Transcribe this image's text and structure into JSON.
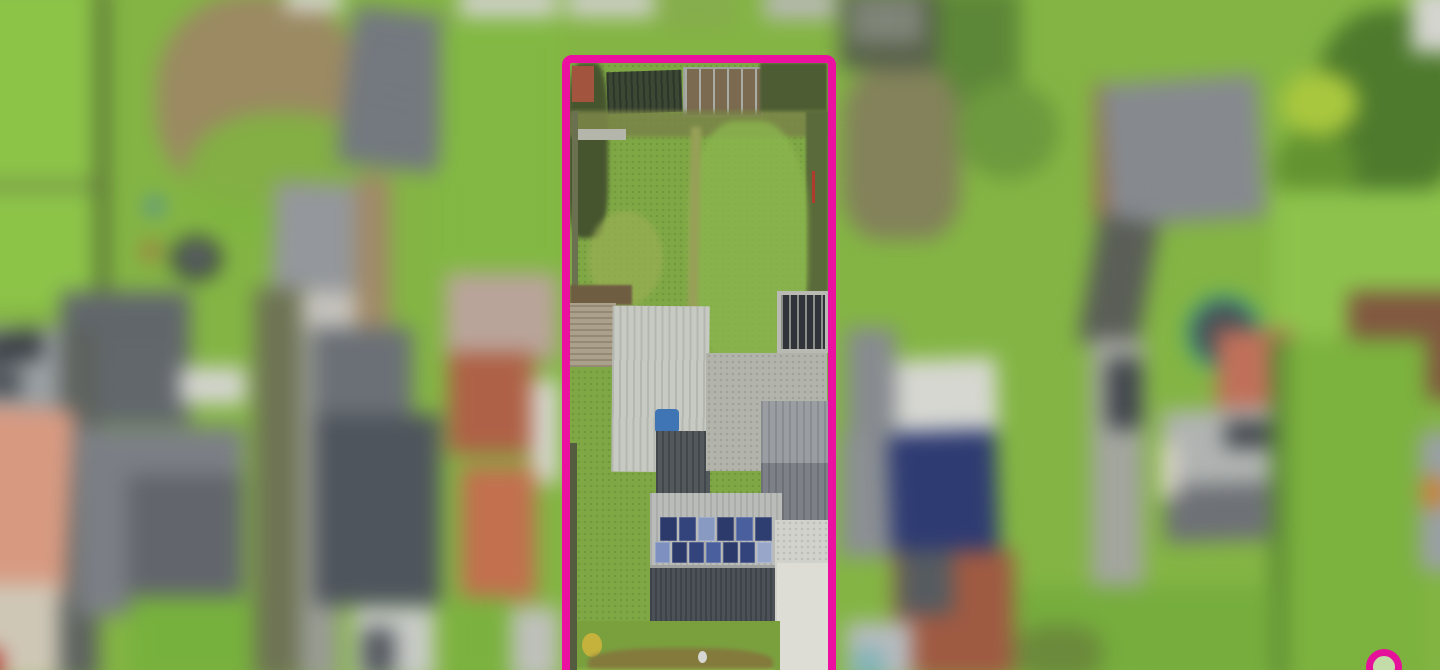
{
  "image": {
    "kind": "aerial-drone-photograph",
    "subject": "residential plot outlined with magenta boundary, surroundings blurred"
  },
  "colors": {
    "boundary": "#EC10A0",
    "watermark": "#E5119B",
    "base_grass": "#84B544",
    "plot_grass": "#7FA845"
  },
  "background": [
    {
      "n": "lawn-top-left",
      "x": 0,
      "y": 0,
      "w": 125,
      "h": 310,
      "c": "#8cc448"
    },
    {
      "n": "fence-line-top-left",
      "x": 118,
      "y": 0,
      "w": 9,
      "h": 295,
      "c": "#44502f"
    },
    {
      "n": "dead-shrub-patch",
      "x": 175,
      "y": 5,
      "w": 200,
      "h": 205,
      "c": "#9b8a62",
      "rad": "45%"
    },
    {
      "n": "grass-over-shrub",
      "x": 205,
      "y": 120,
      "w": 185,
      "h": 125,
      "c": "#7fb53f",
      "rad": "45%",
      "op": 0.85
    },
    {
      "n": "white-roof-top-1",
      "x": 300,
      "y": 0,
      "w": 55,
      "h": 22,
      "c": "#d6d7d0"
    },
    {
      "n": "grey-roof-top-left",
      "x": 358,
      "y": 22,
      "w": 98,
      "h": 152,
      "c": "#70757b",
      "rot": 7,
      "st": {
        "d": 7,
        "c": "#7e838a",
        "t": 3,
        "s": 12
      }
    },
    {
      "n": "white-roof-top-2",
      "x": 468,
      "y": 0,
      "w": 95,
      "h": 28,
      "c": "#cfd0c9"
    },
    {
      "n": "green-strip-left",
      "x": 450,
      "y": 30,
      "w": 115,
      "h": 270,
      "c": "#82b843"
    },
    {
      "n": "fence-horizontal-left",
      "x": 0,
      "y": 188,
      "w": 118,
      "h": 6,
      "c": "#687748"
    },
    {
      "n": "grey-roof-mid-left",
      "x": 288,
      "y": 188,
      "w": 90,
      "h": 105,
      "c": "#94979b",
      "rot": 2
    },
    {
      "n": "white-wall-mid-left",
      "x": 300,
      "y": 293,
      "w": 75,
      "h": 45,
      "c": "#c6c3bd"
    },
    {
      "n": "tan-lane-vertical",
      "x": 368,
      "y": 180,
      "w": 34,
      "h": 160,
      "c": "#a08a68"
    },
    {
      "n": "blue-barrel",
      "x": 166,
      "y": 203,
      "w": 15,
      "h": 15,
      "c": "#3f7fc1",
      "rad": "50%"
    },
    {
      "n": "red-barrel",
      "x": 163,
      "y": 247,
      "w": 14,
      "h": 14,
      "c": "#bf4a40",
      "rad": "50%"
    },
    {
      "n": "black-tub",
      "x": 190,
      "y": 240,
      "w": 48,
      "h": 42,
      "c": "#383d42",
      "rad": "50%"
    },
    {
      "n": "black-tub-inner",
      "x": 202,
      "y": 250,
      "w": 24,
      "h": 20,
      "c": "#6e7478",
      "rad": "50%"
    },
    {
      "n": "barn-roof-left",
      "x": 83,
      "y": 293,
      "w": 125,
      "h": 128,
      "c": "#676c71",
      "st": {
        "d": 0,
        "c": "#565b60",
        "t": 4,
        "s": 13
      }
    },
    {
      "n": "white-strip-mid-left",
      "x": 198,
      "y": 366,
      "w": 64,
      "h": 36,
      "c": "#d3d4ce"
    },
    {
      "n": "dark-path-vertical-left",
      "x": 80,
      "y": 330,
      "w": 40,
      "h": 340,
      "c": "#5e635f"
    },
    {
      "n": "driveway-cars-top-left",
      "x": 0,
      "y": 328,
      "w": 82,
      "h": 84,
      "c": "#9aa0a3"
    },
    {
      "n": "parked-car-1",
      "x": 8,
      "y": 332,
      "w": 58,
      "h": 30,
      "c": "#3c4147",
      "rot": -8,
      "rad": 6
    },
    {
      "n": "parked-car-2",
      "x": 5,
      "y": 368,
      "w": 40,
      "h": 26,
      "c": "#4a5056",
      "rot": 5,
      "rad": 6
    },
    {
      "n": "salmon-tiled-roof",
      "x": -8,
      "y": 405,
      "w": 100,
      "h": 180,
      "c": "#d79a81",
      "rot": 3
    },
    {
      "n": "dusty-pink-patio",
      "x": 455,
      "y": 275,
      "w": 108,
      "h": 85,
      "c": "#b9a49a"
    },
    {
      "n": "grey-house-left-roof",
      "x": 98,
      "y": 424,
      "w": 162,
      "h": 182,
      "c": "#7b7f85"
    },
    {
      "n": "grey-house-left-slope",
      "x": 148,
      "y": 470,
      "w": 112,
      "h": 136,
      "c": "#62666c"
    },
    {
      "n": "lawn-bottom-left",
      "x": 150,
      "y": 588,
      "w": 125,
      "h": 82,
      "c": "#77b13d"
    },
    {
      "n": "tan-pavement-bottom-left",
      "x": 0,
      "y": 575,
      "w": 82,
      "h": 95,
      "c": "#cfc7b6"
    },
    {
      "n": "red-car",
      "x": 0,
      "y": 638,
      "w": 26,
      "h": 32,
      "c": "#b2332c",
      "rad": 6
    },
    {
      "n": "olive-lane-vertical",
      "x": 270,
      "y": 290,
      "w": 46,
      "h": 380,
      "c": "#6e7354"
    },
    {
      "n": "grey-road-vertical-left",
      "x": 314,
      "y": 328,
      "w": 38,
      "h": 342,
      "c": "#999c93"
    },
    {
      "n": "house-center-left-upper",
      "x": 328,
      "y": 328,
      "w": 95,
      "h": 88,
      "c": "#6b7076"
    },
    {
      "n": "house-center-left-roof",
      "x": 328,
      "y": 412,
      "w": 122,
      "h": 184,
      "c": "#4f555d"
    },
    {
      "n": "brick-building-1",
      "x": 458,
      "y": 352,
      "w": 82,
      "h": 98,
      "c": "#ae6146"
    },
    {
      "n": "white-gap-left-of-plot",
      "x": 538,
      "y": 378,
      "w": 26,
      "h": 100,
      "c": "#d7d8d2"
    },
    {
      "n": "brick-building-2",
      "x": 470,
      "y": 462,
      "w": 72,
      "h": 128,
      "c": "#c2704e"
    },
    {
      "n": "lawn-under-brick",
      "x": 456,
      "y": 588,
      "w": 62,
      "h": 82,
      "c": "#7bb23f"
    },
    {
      "n": "white-drive-bottom-center",
      "x": 366,
      "y": 598,
      "w": 78,
      "h": 72,
      "c": "#c8cbc7"
    },
    {
      "n": "dark-car-bottom-center",
      "x": 374,
      "y": 618,
      "w": 32,
      "h": 48,
      "c": "#555a60",
      "rad": 5
    },
    {
      "n": "grey-patch-below-plot-left",
      "x": 518,
      "y": 598,
      "w": 47,
      "h": 72,
      "c": "#bec0ba"
    },
    {
      "n": "white-roof-above-plot",
      "x": 572,
      "y": 0,
      "w": 85,
      "h": 28,
      "c": "#cdcec7"
    },
    {
      "n": "green-above-plot",
      "x": 660,
      "y": 0,
      "w": 75,
      "h": 40,
      "c": "#86ad4c"
    },
    {
      "n": "grey-roof-above-plot",
      "x": 762,
      "y": 0,
      "w": 70,
      "h": 30,
      "c": "#b6b8b1"
    },
    {
      "n": "greenhouses-top-right",
      "x": 836,
      "y": 0,
      "w": 100,
      "h": 78,
      "c": "#57614a"
    },
    {
      "n": "greenhouse-frames",
      "x": 845,
      "y": 8,
      "w": 70,
      "h": 45,
      "c": "#8d9188",
      "st": {
        "d": 90,
        "c": "#5c6650",
        "t": 3,
        "s": 10
      }
    },
    {
      "n": "shrub-column-right",
      "x": 930,
      "y": 0,
      "w": 80,
      "h": 135,
      "c": "#5d8738"
    },
    {
      "n": "brown-shrubs-right",
      "x": 838,
      "y": 78,
      "w": 115,
      "h": 165,
      "c": "#83825a",
      "rad": "30%"
    },
    {
      "n": "tree-blob-right",
      "x": 948,
      "y": 90,
      "w": 100,
      "h": 95,
      "c": "#6d9a3e",
      "rad": "50%"
    },
    {
      "n": "brick-edge-of-barn",
      "x": 1082,
      "y": 92,
      "w": 14,
      "h": 132,
      "c": "#996a50"
    },
    {
      "n": "barn-roof-right",
      "x": 1092,
      "y": 88,
      "w": 152,
      "h": 138,
      "c": "#898d92",
      "rot": -4,
      "st": {
        "d": 0,
        "c": "#797d82",
        "t": 3,
        "s": 14
      }
    },
    {
      "n": "conifer-trees-1",
      "x": 1295,
      "y": 20,
      "w": 145,
      "h": 185,
      "c": "#4e7a2d",
      "rad": "45%"
    },
    {
      "n": "conifer-trees-2",
      "x": 1255,
      "y": 135,
      "w": 80,
      "h": 80,
      "c": "#639331",
      "rad": "50%"
    },
    {
      "n": "lime-bush",
      "x": 1262,
      "y": 80,
      "w": 75,
      "h": 62,
      "c": "#a9c73e",
      "rad": "50%"
    },
    {
      "n": "white-corner-top-right",
      "x": 1388,
      "y": 0,
      "w": 52,
      "h": 62,
      "c": "#d4d5cf"
    },
    {
      "n": "lawn-top-right",
      "x": 1255,
      "y": 195,
      "w": 185,
      "h": 145,
      "c": "#8dc34c"
    },
    {
      "n": "driveway-curve-right",
      "x": 1076,
      "y": 222,
      "w": 58,
      "h": 125,
      "c": "#5a5e57",
      "rot": 10
    },
    {
      "n": "trampoline",
      "x": 1171,
      "y": 297,
      "w": 58,
      "h": 58,
      "c": "#4a4f55",
      "rad": "50%",
      "bd": {
        "w": 7,
        "c": "#2e9c8c"
      }
    },
    {
      "n": "allotment-beds",
      "x": 1327,
      "y": 293,
      "w": 113,
      "h": 104,
      "c": "#8a5f45",
      "st": {
        "d": 0,
        "c": "#6e4a36",
        "t": 4,
        "s": 12
      }
    },
    {
      "n": "grey-road-vertical-right",
      "x": 1078,
      "y": 338,
      "w": 52,
      "h": 332,
      "c": "#a2a59d"
    },
    {
      "n": "car-on-road-right",
      "x": 1094,
      "y": 358,
      "w": 34,
      "h": 68,
      "c": "#42474d",
      "rad": 8
    },
    {
      "n": "salmon-wall-right-house",
      "x": 1200,
      "y": 330,
      "w": 75,
      "h": 80,
      "c": "#c0705a"
    },
    {
      "n": "house-right-upper-slope",
      "x": 1148,
      "y": 405,
      "w": 185,
      "h": 78,
      "c": "#b0b3b1",
      "rot": -2
    },
    {
      "n": "house-right-skylight",
      "x": 1208,
      "y": 418,
      "w": 52,
      "h": 26,
      "c": "#44484e"
    },
    {
      "n": "house-right-lower-slope",
      "x": 1150,
      "y": 478,
      "w": 180,
      "h": 55,
      "c": "#6e7176",
      "rot": -2
    },
    {
      "n": "house-right-white-wall",
      "x": 1146,
      "y": 438,
      "w": 16,
      "h": 55,
      "c": "#ded6cc"
    },
    {
      "n": "dark-bush-right",
      "x": 1318,
      "y": 432,
      "w": 28,
      "h": 26,
      "c": "#3a3f35",
      "rad": "50%"
    },
    {
      "n": "hedge-line-right",
      "x": 1252,
      "y": 338,
      "w": 16,
      "h": 332,
      "c": "#5c8934"
    },
    {
      "n": "lawn-right-mid",
      "x": 1268,
      "y": 338,
      "w": 135,
      "h": 332,
      "c": "#7cb23e"
    },
    {
      "n": "grey-edge-far-right",
      "x": 1396,
      "y": 428,
      "w": 44,
      "h": 135,
      "c": "#9aa0a4"
    },
    {
      "n": "orange-object-far-right",
      "x": 1398,
      "y": 472,
      "w": 24,
      "h": 30,
      "c": "#cf8030",
      "rad": "40%"
    },
    {
      "n": "grey-roof-right-of-plot",
      "x": 836,
      "y": 430,
      "w": 54,
      "h": 120,
      "c": "#8b8f93"
    },
    {
      "n": "solar-building-white-roof",
      "x": 884,
      "y": 358,
      "w": 104,
      "h": 72,
      "c": "#d6d7d1",
      "rot": -2
    },
    {
      "n": "solar-building-panels",
      "x": 884,
      "y": 428,
      "w": 104,
      "h": 118,
      "c": "#333f7a",
      "rot": -2,
      "st": {
        "d": 90,
        "c": "#22305e",
        "t": 3,
        "s": 11
      }
    },
    {
      "n": "grey-shed-right-of-plot",
      "x": 842,
      "y": 328,
      "w": 48,
      "h": 105,
      "c": "#878b8f"
    },
    {
      "n": "brick-building-bottom-right",
      "x": 888,
      "y": 543,
      "w": 116,
      "h": 124,
      "c": "#9f5a42"
    },
    {
      "n": "brick-dark-section",
      "x": 893,
      "y": 543,
      "w": 52,
      "h": 62,
      "c": "#565b60"
    },
    {
      "n": "cars-bottom-right",
      "x": 842,
      "y": 612,
      "w": 64,
      "h": 58,
      "c": "#b6bbbf"
    },
    {
      "n": "teal-car",
      "x": 848,
      "y": 638,
      "w": 30,
      "h": 32,
      "c": "#7fb3b7",
      "rad": 6
    },
    {
      "n": "lawn-bottom-far-right",
      "x": 1005,
      "y": 578,
      "w": 250,
      "h": 92,
      "c": "#76ad3d"
    },
    {
      "n": "shrub-bottom-right",
      "x": 1005,
      "y": 615,
      "w": 85,
      "h": 55,
      "c": "#6b8a3b",
      "rad": "40%"
    }
  ],
  "plot": {
    "x": 562,
    "y": 55,
    "w": 274,
    "h": 645,
    "border_w": 8,
    "border_c": "#EC10A0",
    "radius": 10,
    "base": "#7FA845",
    "elements": [
      {
        "n": "plot-grass-base",
        "x": 0,
        "y": 0,
        "w": 258,
        "h": 637,
        "c": "#7fa845",
        "sp": true
      },
      {
        "n": "dark-shrubs-top-left",
        "x": -2,
        "y": 0,
        "w": 40,
        "h": 175,
        "c": "#47552f",
        "rad": "30%",
        "blur": 2
      },
      {
        "n": "brick-store",
        "x": 2,
        "y": 3,
        "w": 22,
        "h": 36,
        "c": "#a3543e"
      },
      {
        "n": "shed-roof",
        "x": 37,
        "y": 8,
        "w": 75,
        "h": 42,
        "c": "#3c4734",
        "rot": -2,
        "st": {
          "d": 90,
          "c": "#2d3628",
          "t": 2,
          "s": 6
        }
      },
      {
        "n": "greenhouse",
        "x": 113,
        "y": 4,
        "w": 76,
        "h": 46,
        "c": "#7b6a4f",
        "bd": {
          "w": 2,
          "c": "#9ea29a"
        },
        "st": {
          "d": 90,
          "c": "#a8aca4",
          "t": 2,
          "s": 14
        }
      },
      {
        "n": "hedge-top-right",
        "x": 190,
        "y": 0,
        "w": 67,
        "h": 50,
        "c": "#4e5c33",
        "blur": 1
      },
      {
        "n": "mud-band",
        "x": 0,
        "y": 48,
        "w": 258,
        "h": 26,
        "c": "#7a8548",
        "blur": 2,
        "op": 0.9
      },
      {
        "n": "stone-wall-bit",
        "x": 8,
        "y": 66,
        "w": 48,
        "h": 11,
        "c": "#b4b5ab"
      },
      {
        "n": "left-fence",
        "x": 2,
        "y": 48,
        "w": 6,
        "h": 255,
        "c": "#6b7150"
      },
      {
        "n": "hedge-right-strip",
        "x": 236,
        "y": 48,
        "w": 22,
        "h": 200,
        "c": "#5a6a3a",
        "blur": 1
      },
      {
        "n": "red-pole",
        "x": 242,
        "y": 108,
        "w": 3,
        "h": 32,
        "c": "#b03a2e"
      },
      {
        "n": "lawn-bright-patch",
        "x": 118,
        "y": 58,
        "w": 120,
        "h": 245,
        "c": "#8bb54e",
        "rad": "40%",
        "blur": 3,
        "op": 0.8
      },
      {
        "n": "lawn-yellow-patch",
        "x": 18,
        "y": 148,
        "w": 75,
        "h": 95,
        "c": "#9aae54",
        "rad": "50%",
        "blur": 3,
        "op": 0.7
      },
      {
        "n": "worn-path",
        "x": 119,
        "y": 64,
        "w": 10,
        "h": 246,
        "c": "#98a058",
        "blur": 2,
        "rot": 1
      },
      {
        "n": "soil-strip",
        "x": 0,
        "y": 222,
        "w": 62,
        "h": 20,
        "c": "#6f5d42",
        "blur": 1
      },
      {
        "n": "decking",
        "x": 0,
        "y": 240,
        "w": 46,
        "h": 64,
        "c": "#aaa08b",
        "st": {
          "d": 0,
          "c": "#948a74",
          "t": 2,
          "s": 6
        }
      },
      {
        "n": "workshop-roof",
        "x": 42,
        "y": 243,
        "w": 97,
        "h": 166,
        "c": "#c7c9c3",
        "rot": 0.5,
        "st": {
          "d": 90,
          "c": "#b4b6b0",
          "t": 2,
          "s": 7
        }
      },
      {
        "n": "blue-pool",
        "x": 85,
        "y": 346,
        "w": 24,
        "h": 24,
        "c": "#3f74b5",
        "rad": 4
      },
      {
        "n": "dark-roof-extension",
        "x": 86,
        "y": 368,
        "w": 54,
        "h": 64,
        "c": "#53585c",
        "st": {
          "d": 90,
          "c": "#42474b",
          "t": 2,
          "s": 6
        }
      },
      {
        "n": "trellis-frame",
        "x": 207,
        "y": 228,
        "w": 52,
        "h": 62,
        "c": "#b9bab3"
      },
      {
        "n": "trellis-grid",
        "x": 211,
        "y": 232,
        "w": 44,
        "h": 54,
        "c": "#30343a",
        "st": {
          "d": 90,
          "c": "#8b8f88",
          "t": 2,
          "s": 8
        }
      },
      {
        "n": "gravel-patio",
        "x": 136,
        "y": 290,
        "w": 121,
        "h": 118,
        "c": "#b2b4ac",
        "sp": true
      },
      {
        "n": "garage-roof-upper",
        "x": 191,
        "y": 338,
        "w": 67,
        "h": 62,
        "c": "#9a9ea3",
        "st": {
          "d": 90,
          "c": "#898d92",
          "t": 2,
          "s": 7
        }
      },
      {
        "n": "garage-roof-lower",
        "x": 191,
        "y": 400,
        "w": 67,
        "h": 64,
        "c": "#7d8187",
        "st": {
          "d": 90,
          "c": "#6d7177",
          "t": 2,
          "s": 7
        }
      },
      {
        "n": "house-upper-slope",
        "x": 80,
        "y": 430,
        "w": 132,
        "h": 75,
        "c": "#b9bcb8",
        "st": {
          "d": 90,
          "c": "#aaada9",
          "t": 2,
          "s": 6
        }
      },
      {
        "n": "house-ridge",
        "x": 80,
        "y": 502,
        "w": 132,
        "h": 5,
        "c": "#9fa29e"
      },
      {
        "n": "house-lower-slope",
        "x": 80,
        "y": 505,
        "w": 132,
        "h": 57,
        "c": "#4c5157",
        "st": {
          "d": 90,
          "c": "#3e434a",
          "t": 2,
          "s": 5
        }
      },
      {
        "n": "house-eave-shadow",
        "x": 80,
        "y": 560,
        "w": 132,
        "h": 6,
        "c": "#35393f"
      },
      {
        "n": "driveway-concrete",
        "x": 205,
        "y": 457,
        "w": 53,
        "h": 180,
        "c": "#d2d2cc",
        "sp": true
      },
      {
        "n": "driveway-bright-patch",
        "x": 207,
        "y": 500,
        "w": 51,
        "h": 137,
        "c": "#dddcd5"
      },
      {
        "n": "garden-bottom-grass",
        "x": 0,
        "y": 558,
        "w": 210,
        "h": 79,
        "c": "#7aa03e"
      },
      {
        "n": "yellow-bush",
        "x": 12,
        "y": 570,
        "w": 20,
        "h": 24,
        "c": "#c4b23c",
        "rad": "50%"
      },
      {
        "n": "autumn-shrub-row",
        "x": 18,
        "y": 585,
        "w": 185,
        "h": 32,
        "c": "#85743c",
        "rad": "40%",
        "blur": 2,
        "op": 0.85
      },
      {
        "n": "bright-grass-band",
        "x": 0,
        "y": 606,
        "w": 205,
        "h": 31,
        "c": "#8fb84a",
        "blur": 2
      },
      {
        "n": "bird-bath",
        "x": 128,
        "y": 588,
        "w": 9,
        "h": 12,
        "c": "#d6d6d2",
        "rad": "50%"
      },
      {
        "n": "left-fence-lower",
        "x": 0,
        "y": 380,
        "w": 7,
        "h": 257,
        "c": "#535c3e"
      }
    ],
    "solar_rows": [
      {
        "x": 90,
        "y": 454,
        "h": 24,
        "pw": 17,
        "gap": 2,
        "colors": [
          "#2c3a6b",
          "#33437c",
          "#8899c2",
          "#2c3a6b",
          "#4a5f9e",
          "#2f3e70"
        ]
      },
      {
        "x": 85,
        "y": 479,
        "h": 21,
        "pw": 15,
        "gap": 2,
        "colors": [
          "#7d90bf",
          "#2c3a6b",
          "#33437c",
          "#4a5f9e",
          "#2c3a6b",
          "#33437c",
          "#98a6c9"
        ]
      }
    ]
  },
  "watermark": {
    "x": 1366,
    "y": 649,
    "size": 36,
    "ring_w": 7,
    "ring_c": "#E5119B",
    "fill": "rgba(255,255,255,0.55)",
    "dot_c": "#E5119B"
  }
}
